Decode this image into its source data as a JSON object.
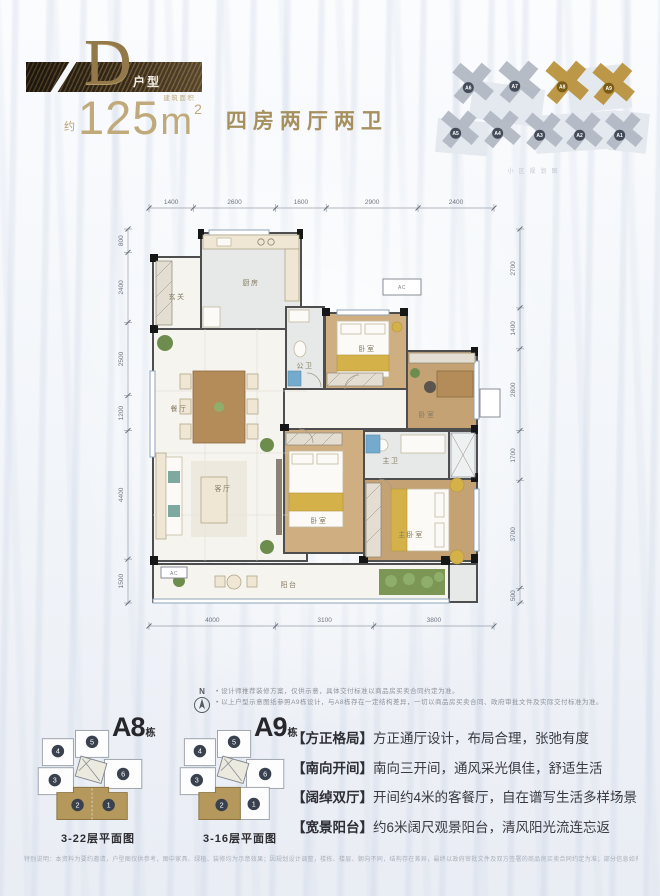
{
  "header": {
    "type_letter": "D",
    "type_suffix": "户型",
    "area_about": "约",
    "area_value": "125",
    "area_unit": "m",
    "area_unit_sup": "2",
    "area_unit_note": "建筑面积",
    "layout_text": "四房两厅两卫"
  },
  "siteplan": {
    "legend": "小区规划图",
    "buildings": [
      {
        "label": "A6",
        "highlighted": false
      },
      {
        "label": "A7",
        "highlighted": false
      },
      {
        "label": "A8",
        "highlighted": true
      },
      {
        "label": "A9",
        "highlighted": true
      },
      {
        "label": "A5",
        "highlighted": false
      },
      {
        "label": "A4",
        "highlighted": false
      },
      {
        "label": "A3",
        "highlighted": false
      },
      {
        "label": "A2",
        "highlighted": false
      },
      {
        "label": "A1",
        "highlighted": false
      }
    ]
  },
  "plan": {
    "rooms": [
      {
        "label": "玄关"
      },
      {
        "label": "厨房"
      },
      {
        "label": "餐厅"
      },
      {
        "label": "公卫"
      },
      {
        "label": "卧室"
      },
      {
        "label": "卧室"
      },
      {
        "label": "客厅"
      },
      {
        "label": "卧室"
      },
      {
        "label": "主卫"
      },
      {
        "label": "主卧室"
      },
      {
        "label": "阳台"
      }
    ],
    "ac_label": "AC",
    "dimensions": {
      "top": [
        1400,
        2600,
        1600,
        2900,
        2400
      ],
      "left": [
        800,
        2400,
        2500,
        1200,
        4400,
        1500
      ],
      "right": [
        2700,
        1400,
        2800,
        1700,
        3700,
        500
      ],
      "bottom": [
        4000,
        3100,
        3800
      ]
    }
  },
  "compass_label": "N",
  "notes": [
    "• 设计师推荐装修方案，仅供示意，具体交付标准以商品房买卖合同约定为准。",
    "• 以上户型示意图纸参照A9栋设计，与A8栋存在一定结构差异，一切以商品房买卖合同、政府审批文件及实际交付标准为准。"
  ],
  "keyplans": [
    {
      "name": "A8",
      "suffix": "栋",
      "caption": "3-22层平面图",
      "units": [
        "1",
        "2",
        "3",
        "4",
        "5",
        "6"
      ]
    },
    {
      "name": "A9",
      "suffix": "栋",
      "caption": "3-16层平面图",
      "units": [
        "1",
        "2",
        "3",
        "4",
        "5",
        "6"
      ]
    }
  ],
  "features": [
    {
      "tag": "【方正格局】",
      "text": "方正通厅设计，布局合理，张弛有度"
    },
    {
      "tag": "【南向开间】",
      "text": "南向三开间，通风采光俱佳，舒适生活"
    },
    {
      "tag": "【阔绰双厅】",
      "text": "开间约4米的客餐厅，自在谱写生活多样场景"
    },
    {
      "tag": "【宽景阳台】",
      "text": "约6米阔尺观景阳台，清风阳光流连忘返"
    }
  ],
  "footnote": "特别说明：本资料为要约邀请，户型图仅供参考，图中家具、绿植、装修均为示意效果；因规划设计调整，楼栋、楼层、朝向不同，结构存在差异，最终以政府审批文件及双方签署的商品房买卖合同约定为准；部分信息如有变动，恕不另行通知。（制作时间：2020年9月）"
}
